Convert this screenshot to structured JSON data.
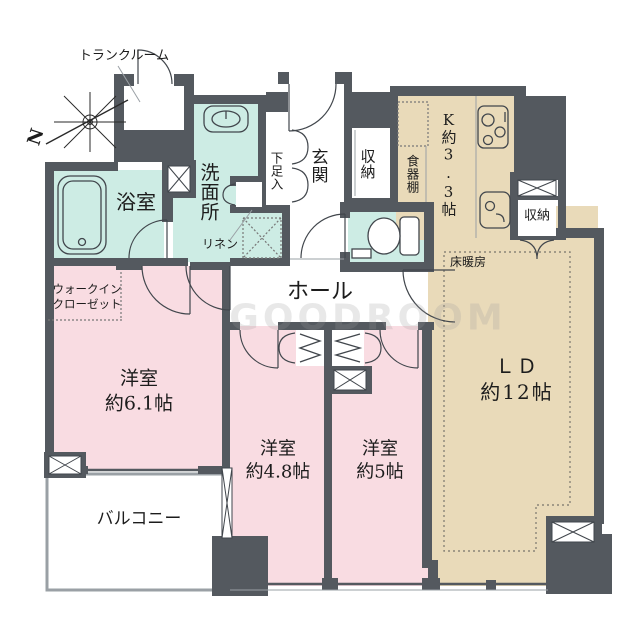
{
  "colors": {
    "wall": "#54595f",
    "mint": "#cdece4",
    "pink": "#f9dce2",
    "beige": "#e9dab9",
    "ink": "#41464c",
    "watermark": "#9b9b9b"
  },
  "compass": {
    "north_label": "N"
  },
  "watermark": {
    "text": "GOODROOM"
  },
  "rooms": {
    "trunk_room": {
      "label": "トランクルーム"
    },
    "bathroom": {
      "label": "浴室"
    },
    "washroom": {
      "label": "洗面所"
    },
    "linen": {
      "label": "リネン"
    },
    "shoe_cabinet": {
      "label": "下足入"
    },
    "entrance": {
      "label": "玄関"
    },
    "entrance_storage": {
      "label": "収納"
    },
    "cupboard": {
      "label": "食器棚"
    },
    "kitchen": {
      "label": "K約3.3帖"
    },
    "ld_storage": {
      "label": "収納"
    },
    "floor_heating": {
      "label": "床暖房"
    },
    "hall": {
      "label": "ホール"
    },
    "walk_in_closet": {
      "label_line1": "ウォークイン",
      "label_line2": "クローゼット"
    },
    "bedroom_6_1": {
      "label_line1": "洋室",
      "label_line2": "約6.1帖"
    },
    "bedroom_4_8": {
      "label_line1": "洋室",
      "label_line2": "約4.8帖"
    },
    "bedroom_5": {
      "label_line1": "洋室",
      "label_line2": "約5帖"
    },
    "living_dining": {
      "label_line1": "ＬＤ",
      "label_line2": "約12帖"
    },
    "balcony": {
      "label": "バルコニー"
    }
  }
}
